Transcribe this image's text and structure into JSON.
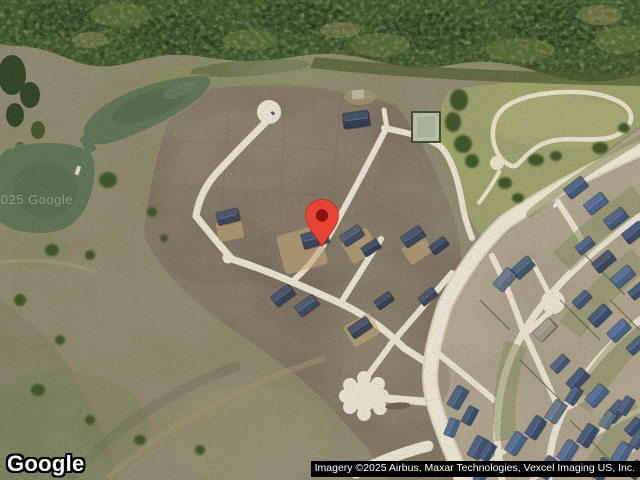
{
  "map": {
    "alt": "Satellite aerial view of a residential development with pond, forest, park and new neighborhood",
    "logo": "Google",
    "attribution": "Imagery ©2025 Airbus, Maxar Technologies, Vexcel Imaging US, Inc.",
    "watermark": "©2025 Google",
    "marker": {
      "color": "#EA4335",
      "dot_color": "#871510",
      "tip_x": 322,
      "tip_y": 246
    }
  },
  "palette": {
    "forest_green": "#33471F",
    "pond_green": "#5D7354",
    "dirt_brown": "#7E705F",
    "scrub_olive": "#8B8568",
    "road_cream": "#E9E1CF",
    "roof_slate": "#3B5070",
    "park_grass": "#9DA565",
    "attribution_bg": "#000000",
    "attribution_text": "#FFFFFF"
  }
}
